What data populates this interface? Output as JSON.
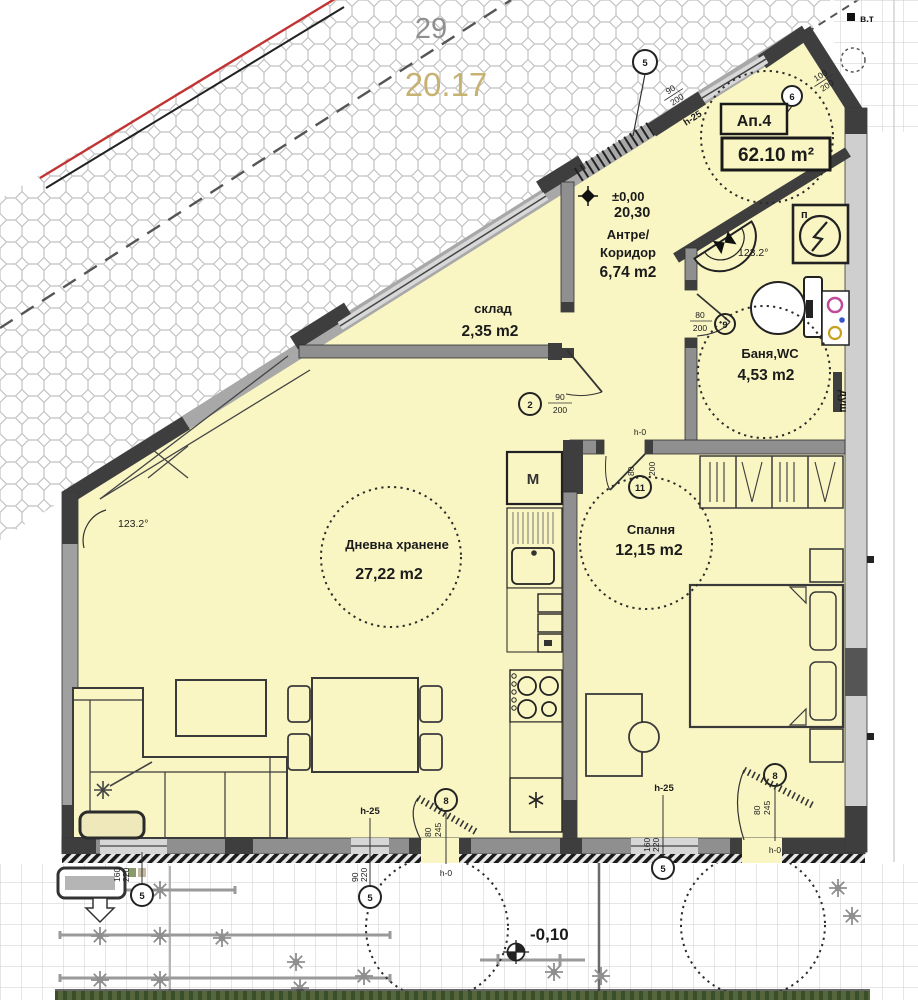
{
  "site": {
    "lot": "29",
    "elevation": "20.17",
    "benchmark": "в.т"
  },
  "apartment": {
    "number": "Ап.4",
    "total_area": "62.10 m²"
  },
  "levels": {
    "entry_level": "±0,00",
    "entry_abs": "20,30",
    "terrace_level": "-0,10"
  },
  "rooms": {
    "hall_name1": "Антре/",
    "hall_name2": "Коридор",
    "hall_area": "6,74 m2",
    "storage_name": "склад",
    "storage_area": "2,35 m2",
    "bath_name": "Баня,WC",
    "bath_area": "4,53 m2",
    "living_name": "Дневна хранене",
    "living_area": "27,22 m2",
    "bedroom_name": "Спалня",
    "bedroom_area": "12,15 m2"
  },
  "angles": {
    "living_corner": "123.2°",
    "bath_corner": "123.2°"
  },
  "fixtures": {
    "washer": "M",
    "shower": "душ",
    "panel": "п"
  },
  "heights": {
    "sill": "h-25",
    "threshold": "h-0"
  },
  "openings": {
    "entry": {
      "no": "5",
      "w": "90",
      "h": "200"
    },
    "vestibule_window": {
      "no": "6",
      "w": "100",
      "h": "200"
    },
    "storage_door": {
      "no": "2",
      "w": "90",
      "h": "200"
    },
    "bath_door": {
      "no": "9",
      "w": "80",
      "h": "200"
    },
    "bedroom_door": {
      "no": "11",
      "w": "80",
      "h": "200"
    },
    "living_balcony": {
      "no": "8",
      "w": "80",
      "h": "245"
    },
    "bedroom_balcony": {
      "no": "8",
      "w": "80",
      "h": "245"
    },
    "left_window": {
      "no": "5",
      "w": "160",
      "h": "220"
    },
    "mid_window": {
      "no": "5",
      "w": "90",
      "h": "220"
    },
    "bedroom_window": {
      "no": "5",
      "w": "160",
      "h": "220"
    }
  }
}
